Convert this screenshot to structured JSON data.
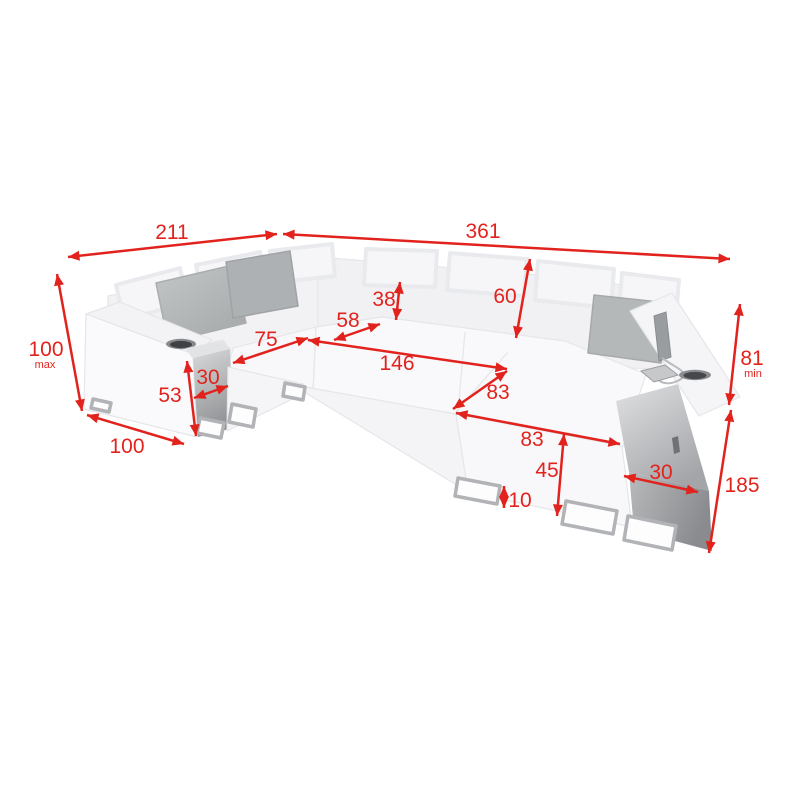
{
  "diagram": {
    "kind": "corner-sofa-dimension-diagram",
    "units_shown": "none (numeric values only)"
  },
  "colors": {
    "background": "#ffffff",
    "dimension_red": "#e2231d",
    "sofa_light": "#f8f8fa",
    "sofa_mid": "#f2f2f5",
    "pillow_gray": "#b5b8b9",
    "shelf_dark": "#8f9194",
    "leg_gray": "#b1b3b6"
  },
  "visible_features": [
    "cup-holder-left",
    "cup-holder-right",
    "phone-on-armrest",
    "charging-cable",
    "throw-pillows",
    "metal-frame-legs",
    "side-shelf-left",
    "side-shelf-right",
    "adjustable-headrests"
  ],
  "dims": {
    "left_back_width": "211",
    "right_back_width": "361",
    "height_max": "100",
    "height_max_suffix": "max",
    "left_arm_depth": "100",
    "shelf_height": "53",
    "left_shelf_width": "30",
    "left_seat_width": "75",
    "corner_seat_width": "58",
    "headrest_height": "38",
    "backrest_height": "60",
    "main_seat_width": "146",
    "seat_depth": "83",
    "chaise_length": "83",
    "front_height": "45",
    "leg_height": "10",
    "right_shelf_width": "30",
    "right_side_length": "185",
    "height_min": "81",
    "height_min_suffix": "min"
  }
}
